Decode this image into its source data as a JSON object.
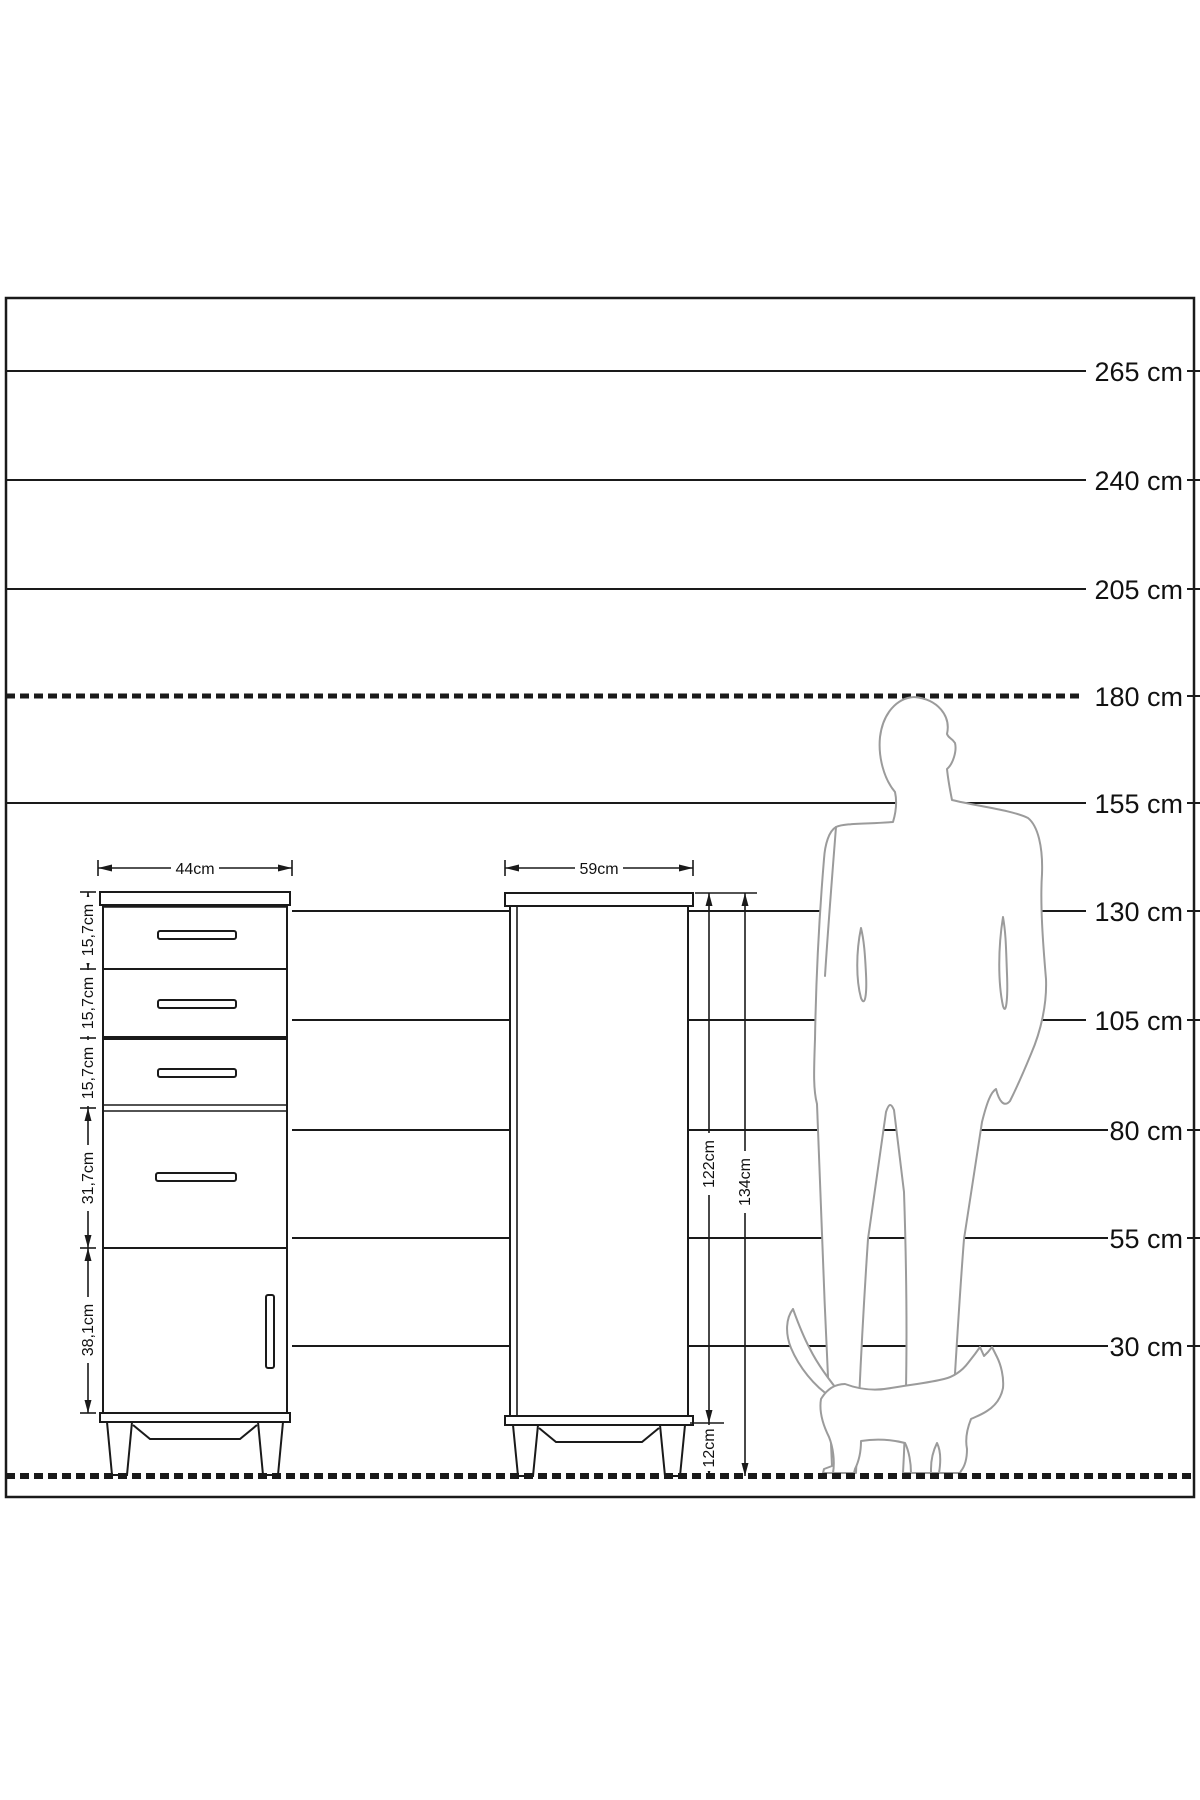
{
  "figure": {
    "scale": {
      "labels": [
        "265 cm",
        "240 cm",
        "205 cm",
        "180 cm",
        "155 cm",
        "130 cm",
        "105 cm",
        "80 cm",
        "55 cm",
        "30 cm"
      ]
    },
    "cabinet": {
      "width_label": "44cm",
      "section_labels": [
        "15,7cm",
        "15,7cm",
        "15,7cm",
        "31,7cm",
        "38,1cm"
      ]
    },
    "wardrobe": {
      "width_label": "59cm",
      "body_height_label": "122cm",
      "total_height_label": "134cm",
      "leg_height_label": "12cm"
    },
    "colors": {
      "line": "#1a1a1a",
      "silhouette": "#9b9b9b",
      "background": "#ffffff"
    }
  }
}
